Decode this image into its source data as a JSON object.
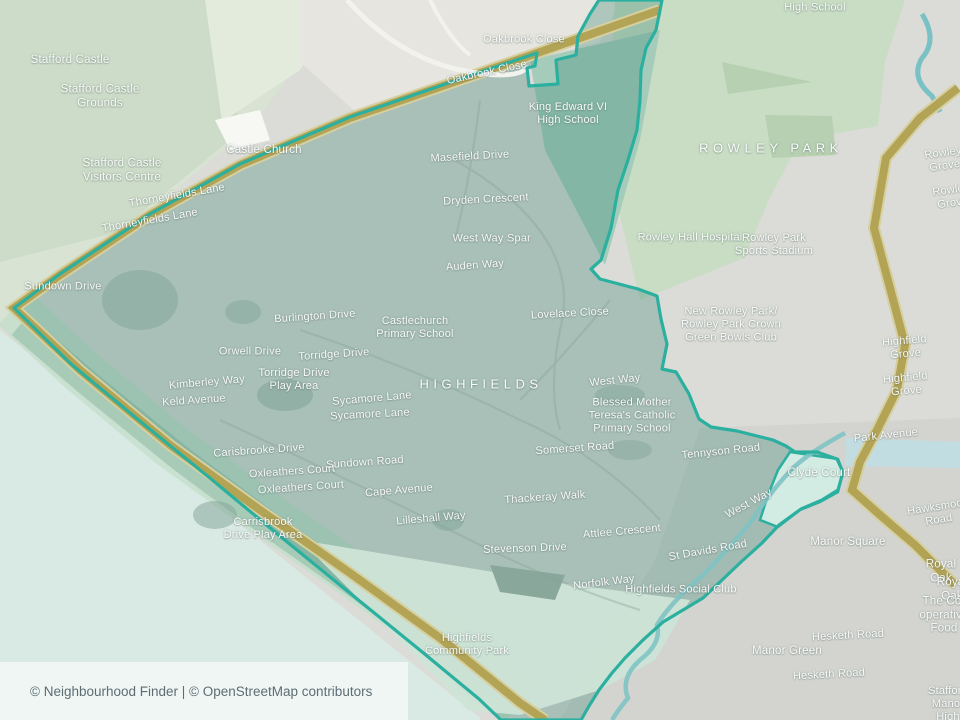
{
  "map": {
    "attribution": "© Neighbourhood Finder | © OpenStreetMap contributors",
    "neighbourhood_name": "HIGHFIELDS",
    "colors": {
      "boundary": "#2bb0a0",
      "road_primary": "#b2a355",
      "water": "#7fc3c3",
      "park_green": "#c8ddc4",
      "neighbourhood_fill": "#8fb3a8",
      "attribution_bg": "#eff6f3"
    },
    "labels": [
      {
        "name": "stafford-castle",
        "text": "Stafford Castle",
        "x": 70,
        "y": 61,
        "cls": "place"
      },
      {
        "name": "stafford-castle-grounds",
        "text": "Stafford Castle\nGrounds",
        "x": 100,
        "y": 97,
        "cls": "place"
      },
      {
        "name": "oakbrook-close-1",
        "text": "Oakbrook Close",
        "x": 524,
        "y": 40,
        "cls": "road"
      },
      {
        "name": "oakbrook-close-2",
        "text": "Oakbrook Close",
        "x": 487,
        "y": 73,
        "cls": "road",
        "rot": -12
      },
      {
        "name": "king-edward-vi-high-school",
        "text": "King Edward VI\nHigh School",
        "x": 568,
        "y": 114,
        "cls": "poi"
      },
      {
        "name": "high-school",
        "text": "High School",
        "x": 815,
        "y": 8,
        "cls": "poi"
      },
      {
        "name": "castle-church",
        "text": "Castle Church",
        "x": 264,
        "y": 151,
        "cls": "place"
      },
      {
        "name": "masefield-drive",
        "text": "Masefield Drive",
        "x": 470,
        "y": 157,
        "cls": "road",
        "rot": -3
      },
      {
        "name": "stafford-castle-visitors-centre",
        "text": "Stafford Castle\nVisitors Centre",
        "x": 122,
        "y": 171,
        "cls": "place"
      },
      {
        "name": "thorneyfields-lane-1",
        "text": "Thorneyfields Lane",
        "x": 177,
        "y": 196,
        "cls": "road",
        "rot": -10
      },
      {
        "name": "thorneyfields-lane-2",
        "text": "Thorneyfields Lane",
        "x": 150,
        "y": 221,
        "cls": "road",
        "rot": -10
      },
      {
        "name": "dryden-crescent",
        "text": "Dryden Crescent",
        "x": 486,
        "y": 200,
        "cls": "road",
        "rot": -3
      },
      {
        "name": "rowley-park-area",
        "text": "ROWLEY PARK",
        "x": 771,
        "y": 148,
        "cls": "area"
      },
      {
        "name": "rowley-hall-hospital",
        "text": "Rowley Hall Hospital",
        "x": 690,
        "y": 238,
        "cls": "poi"
      },
      {
        "name": "rowley-park-sports-stadium",
        "text": "Rowley Park\nSports Stadium",
        "x": 774,
        "y": 245,
        "cls": "poi"
      },
      {
        "name": "west-way-1",
        "text": "West Way",
        "x": 478,
        "y": 239,
        "cls": "road"
      },
      {
        "name": "spar",
        "text": "Spar",
        "x": 519,
        "y": 239,
        "cls": "poi"
      },
      {
        "name": "auden-way",
        "text": "Auden Way",
        "x": 475,
        "y": 266,
        "cls": "road",
        "rot": -4
      },
      {
        "name": "sundown-drive",
        "text": "Sundown Drive",
        "x": 63,
        "y": 287,
        "cls": "road"
      },
      {
        "name": "rowley-grove-1",
        "text": "Rowley Grove",
        "x": 944,
        "y": 160,
        "cls": "road",
        "rot": -8
      },
      {
        "name": "rowley-grove-2",
        "text": "Rowley Grove",
        "x": 952,
        "y": 197,
        "cls": "road",
        "rot": -8
      },
      {
        "name": "burlington-drive",
        "text": "Burlington Drive",
        "x": 315,
        "y": 317,
        "cls": "road",
        "rot": -4
      },
      {
        "name": "castlechurch-primary-school",
        "text": "Castlechurch\nPrimary School",
        "x": 415,
        "y": 328,
        "cls": "poi"
      },
      {
        "name": "lovelace-close",
        "text": "Lovelace Close",
        "x": 570,
        "y": 314,
        "cls": "road",
        "rot": -3
      },
      {
        "name": "rowley-park-bowls-club",
        "text": "New Rowley Park/\nRowley Park Crown\nGreen Bowls Club",
        "x": 731,
        "y": 325,
        "cls": "poi"
      },
      {
        "name": "orwell-drive",
        "text": "Orwell Drive",
        "x": 250,
        "y": 352,
        "cls": "road"
      },
      {
        "name": "torridge-drive",
        "text": "Torridge Drive",
        "x": 334,
        "y": 355,
        "cls": "road",
        "rot": -4
      },
      {
        "name": "torridge-drive-play-area",
        "text": "Torridge Drive\nPlay Area",
        "x": 294,
        "y": 380,
        "cls": "poi"
      },
      {
        "name": "highfield-grove-1",
        "text": "Highfield Grove",
        "x": 905,
        "y": 348,
        "cls": "road",
        "rot": -5
      },
      {
        "name": "highfield-grove-2",
        "text": "Highfield Grove",
        "x": 906,
        "y": 385,
        "cls": "road",
        "rot": -5
      },
      {
        "name": "kimberley-way",
        "text": "Kimberley Way",
        "x": 207,
        "y": 383,
        "cls": "road",
        "rot": -5
      },
      {
        "name": "keld-avenue",
        "text": "Keld Avenue",
        "x": 194,
        "y": 401,
        "cls": "road",
        "rot": -4
      },
      {
        "name": "highfields-area",
        "text": "HIGHFIELDS",
        "x": 481,
        "y": 384,
        "cls": "area"
      },
      {
        "name": "west-way-2",
        "text": "West Way",
        "x": 615,
        "y": 381,
        "cls": "road",
        "rot": -6
      },
      {
        "name": "sycamore-lane-1",
        "text": "Sycamore Lane",
        "x": 372,
        "y": 399,
        "cls": "road",
        "rot": -5
      },
      {
        "name": "sycamore-lane-2",
        "text": "Sycamore Lane",
        "x": 370,
        "y": 415,
        "cls": "road",
        "rot": -3
      },
      {
        "name": "blessed-mother-teresa-school",
        "text": "Blessed Mother\nTeresa's Catholic\nPrimary School",
        "x": 632,
        "y": 416,
        "cls": "poi"
      },
      {
        "name": "park-avenue",
        "text": "Park Avenue",
        "x": 886,
        "y": 436,
        "cls": "road",
        "rot": -6
      },
      {
        "name": "somerset-road",
        "text": "Somerset Road",
        "x": 575,
        "y": 449,
        "cls": "road",
        "rot": -4
      },
      {
        "name": "tennyson-road",
        "text": "Tennyson Road",
        "x": 721,
        "y": 452,
        "cls": "road",
        "rot": -6
      },
      {
        "name": "carisbrooke-drive",
        "text": "Carisbrooke Drive",
        "x": 259,
        "y": 451,
        "cls": "road",
        "rot": -4
      },
      {
        "name": "sundown-road",
        "text": "Sundown Road",
        "x": 365,
        "y": 463,
        "cls": "road",
        "rot": -4
      },
      {
        "name": "oxleathers-court-1",
        "text": "Oxleathers Court",
        "x": 292,
        "y": 472,
        "cls": "road",
        "rot": -4
      },
      {
        "name": "oxleathers-court-2",
        "text": "Oxleathers Court",
        "x": 301,
        "y": 488,
        "cls": "road",
        "rot": -4
      },
      {
        "name": "clyde-court",
        "text": "Clyde Court",
        "x": 819,
        "y": 474,
        "cls": "place"
      },
      {
        "name": "cape-avenue",
        "text": "Cape Avenue",
        "x": 399,
        "y": 491,
        "cls": "road",
        "rot": -5
      },
      {
        "name": "thackeray-walk",
        "text": "Thackeray Walk",
        "x": 545,
        "y": 498,
        "cls": "road",
        "rot": -4
      },
      {
        "name": "west-way-3",
        "text": "West Way",
        "x": 749,
        "y": 504,
        "cls": "road",
        "rot": -28
      },
      {
        "name": "lilleshall-way",
        "text": "Lilleshall Way",
        "x": 431,
        "y": 519,
        "cls": "road",
        "rot": -5
      },
      {
        "name": "carrisbrook-drive-play-area",
        "text": "Carrisbrook\nDrive Play Area",
        "x": 263,
        "y": 529,
        "cls": "poi"
      },
      {
        "name": "attlee-crescent",
        "text": "Attlee Crescent",
        "x": 622,
        "y": 532,
        "cls": "road",
        "rot": -5
      },
      {
        "name": "manor-square",
        "text": "Manor Square",
        "x": 848,
        "y": 543,
        "cls": "place"
      },
      {
        "name": "hawksmoor-road",
        "text": "Hawksmoor Road",
        "x": 938,
        "y": 514,
        "cls": "road",
        "rot": -9
      },
      {
        "name": "st-davids-road",
        "text": "St Davids Road",
        "x": 708,
        "y": 551,
        "cls": "road",
        "rot": -10
      },
      {
        "name": "stevenson-drive",
        "text": "Stevenson Drive",
        "x": 525,
        "y": 549,
        "cls": "road",
        "rot": -2
      },
      {
        "name": "royal-oak-1",
        "text": "Royal Oak",
        "x": 941,
        "y": 572,
        "cls": "place"
      },
      {
        "name": "royal-oak-2",
        "text": "Royal Oak",
        "x": 952,
        "y": 590,
        "cls": "place"
      },
      {
        "name": "norfolk-way",
        "text": "Norfolk Way",
        "x": 604,
        "y": 583,
        "cls": "road",
        "rot": -7
      },
      {
        "name": "highfields-social-club",
        "text": "Highfields Social Club",
        "x": 681,
        "y": 590,
        "cls": "poi"
      },
      {
        "name": "cooperative-food",
        "text": "The Co-\noperative Food",
        "x": 944,
        "y": 616,
        "cls": "place"
      },
      {
        "name": "hesketh-road-1",
        "text": "Hesketh Road",
        "x": 848,
        "y": 636,
        "cls": "road",
        "rot": -3
      },
      {
        "name": "manor-green",
        "text": "Manor Green",
        "x": 787,
        "y": 652,
        "cls": "place"
      },
      {
        "name": "hesketh-road-2",
        "text": "Hesketh Road",
        "x": 829,
        "y": 675,
        "cls": "road",
        "rot": -3
      },
      {
        "name": "highfields-community-park",
        "text": "Highfields\nCommunity Park",
        "x": 467,
        "y": 645,
        "cls": "poi"
      },
      {
        "name": "stafford-manor-high-school",
        "text": "Stafford Manor\nHigh School",
        "x": 948,
        "y": 711,
        "cls": "poi"
      }
    ]
  }
}
